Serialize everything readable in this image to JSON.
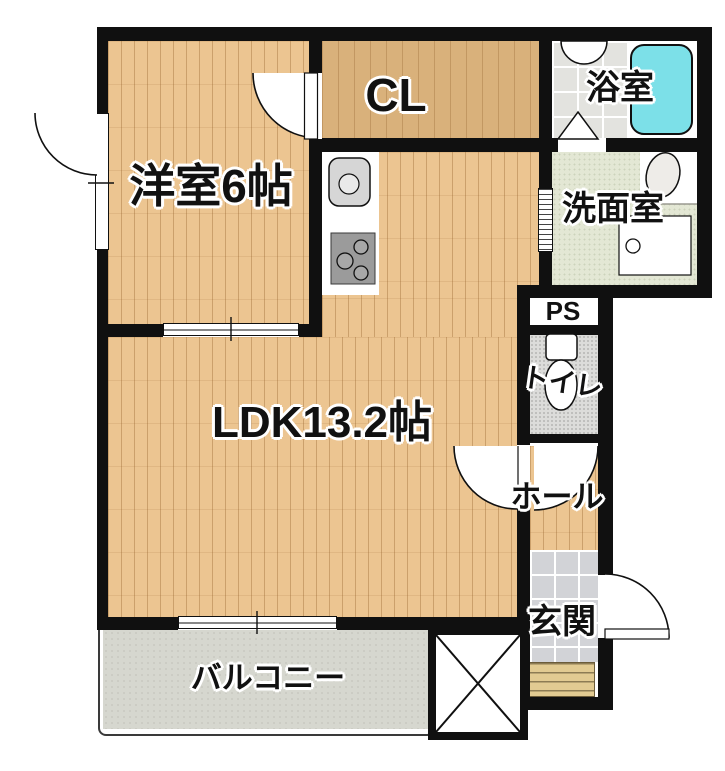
{
  "rooms": {
    "bedroom": {
      "label": "洋室6帖"
    },
    "closet": {
      "label": "CL"
    },
    "bathroom": {
      "label": "浴室"
    },
    "washroom": {
      "label": "洗面室"
    },
    "pipe_space": {
      "label": "PS"
    },
    "toilet": {
      "label": "トイレ"
    },
    "ldk": {
      "label": "LDK13.2帖"
    },
    "hall": {
      "label": "ホール"
    },
    "entrance": {
      "label": "玄関"
    },
    "balcony": {
      "label": "バルコニー"
    }
  },
  "fixtures": [
    "kitchen-sink",
    "stove",
    "bathtub",
    "bathroom-folding-door",
    "bathroom-counter",
    "wash-basin",
    "washing-machine-pan",
    "toilet-bowl",
    "entrance-steps",
    "void-x-mark",
    "entrance-door",
    "bedroom-door",
    "bedroom-window",
    "sliding-door",
    "balcony-window",
    "accordion-door",
    "hall-door",
    "toilet-door"
  ],
  "colors": {
    "wall": "#101010",
    "wood_floor": "#ecc591",
    "closet_floor": "#d9b17b",
    "bathtub": "#7ce0e8",
    "bath_tile": "#e3e3df",
    "washroom_floor": "#e3e7d4",
    "toilet_floor": "#dcdcda",
    "genkan_tile": "#d2d3d7",
    "balcony_floor": "#d6d7cf",
    "steps": "#e2cb92"
  }
}
